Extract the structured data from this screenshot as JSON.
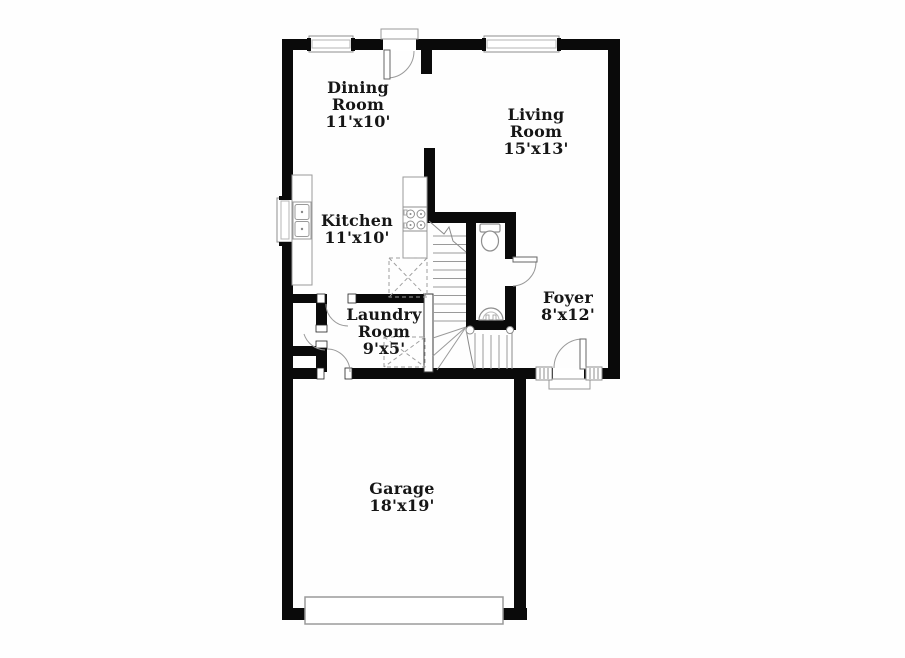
{
  "plan": {
    "title": "First floor plan",
    "rooms": {
      "dining": {
        "name": "Dining Room",
        "size": "11'x10'"
      },
      "living": {
        "name": "Living Room",
        "size": "15'x13'"
      },
      "kitchen": {
        "name": "Kitchen",
        "size": "11'x10'"
      },
      "laundry": {
        "name": "Laundry Room",
        "size": "9'x5'"
      },
      "foyer": {
        "name": "Foyer",
        "size": "8'x12'"
      },
      "garage": {
        "name": "Garage",
        "size": "18'x19'"
      }
    },
    "fixtures": [
      "window",
      "exterior-door-swing",
      "interior-door-swing",
      "kitchen-double-sink",
      "stove-burners",
      "refrigerator-space",
      "washer-dryer-space",
      "toilet",
      "pedestal-sink",
      "staircase-up",
      "stair-winders",
      "garage-door",
      "front-door-sidelites",
      "door-threshold"
    ],
    "colors": {
      "wall": "#0a0a0a",
      "fixture_line": "#8f8f8f",
      "text": "#161616",
      "background": "#fefefe"
    }
  }
}
